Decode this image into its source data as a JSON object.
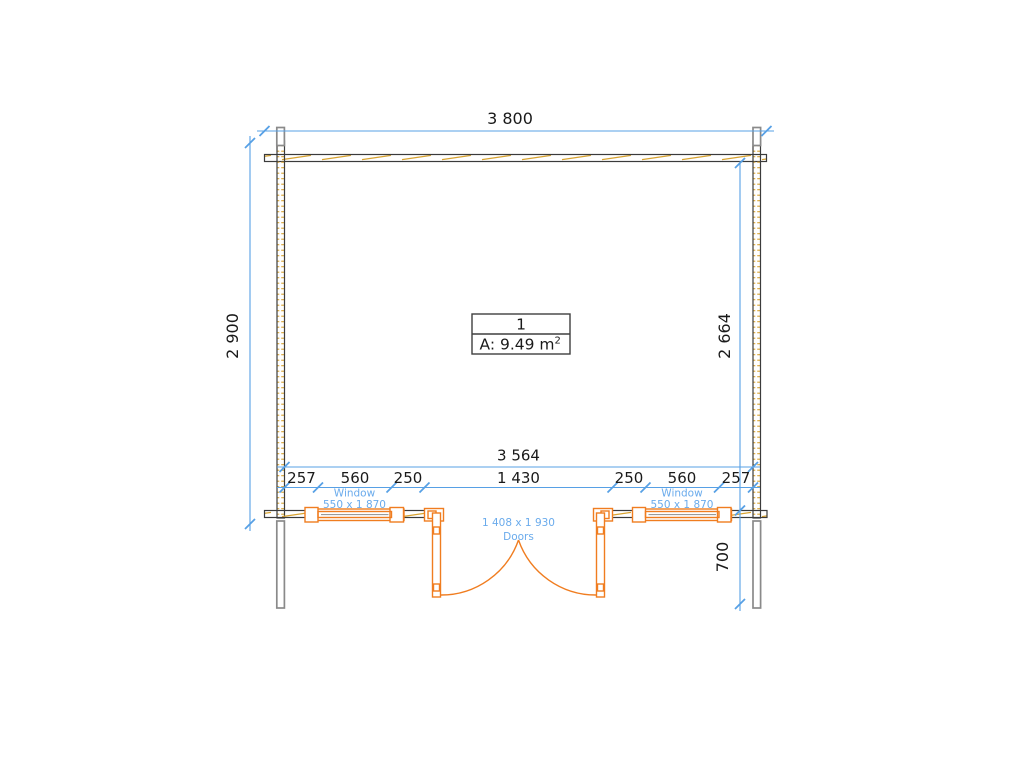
{
  "plan": {
    "room": {
      "number": "1",
      "area_text": "A: 9.49 m",
      "area_sup": "2"
    },
    "dims": {
      "overall_width": "3 800",
      "overall_height": "2 900",
      "inner_height": "2 664",
      "inner_width": "3 564",
      "porch_depth": "700",
      "segments": [
        "257",
        "560",
        "250",
        "1 430",
        "250",
        "560",
        "257"
      ]
    },
    "window_left": {
      "name": "Window",
      "size": "550 x 1 870"
    },
    "window_right": {
      "name": "Window",
      "size": "550 x 1 870"
    },
    "doors": {
      "size": "1 408 x 1 930",
      "name": "Doors"
    },
    "colors": {
      "dimension_blue": "#57a0e5",
      "label_blue": "#6aabec",
      "element_orange": "#f07d20",
      "hatch_gold": "#d8a331",
      "wall_dark": "#3b3b3b",
      "post_gray": "#8a8a8a"
    }
  }
}
